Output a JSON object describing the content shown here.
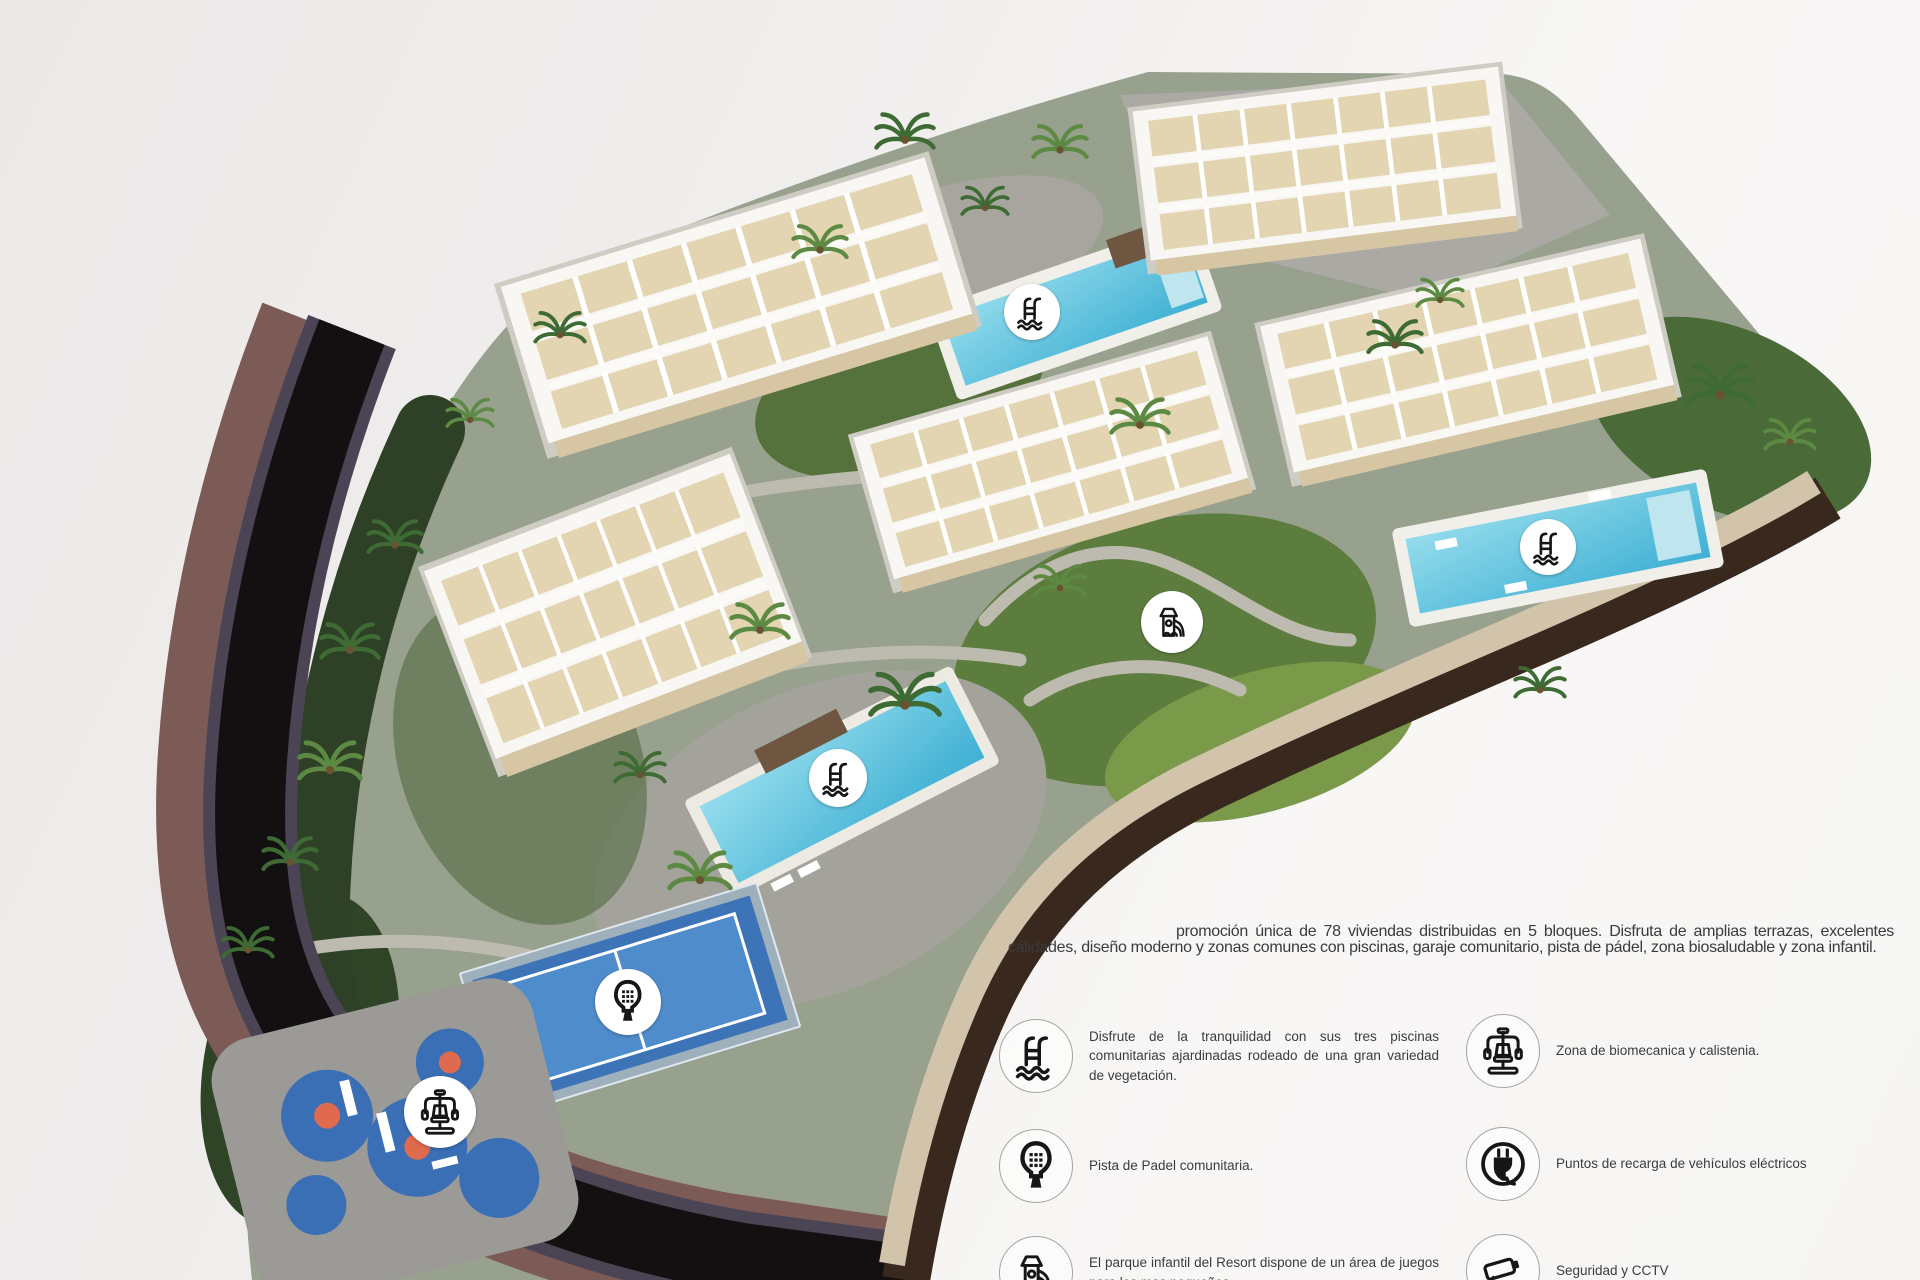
{
  "intro": {
    "text": "promoción única de 78 viviendas distribuidas en 5 bloques. Disfruta de amplias terrazas, excelentes cálidades, diseño moderno y zonas comunes con piscinas, garaje comunitario, pista de pádel, zona biosaludable y zona infantil."
  },
  "legend": {
    "items": [
      {
        "icon": "pool-icon",
        "text": "Disfrute de la tranquilidad con sus tres piscinas comunitarias ajardinadas rodeado de una gran variedad de vegetación."
      },
      {
        "icon": "padel-icon",
        "text": "Pista de Padel comunitaria."
      },
      {
        "icon": "playground-icon",
        "text": "El parque infantil del Resort dispone de un área de juegos para los mas pequeños."
      },
      {
        "icon": "biomechanics-icon",
        "text": "Zona de biomecanica y calistenia."
      },
      {
        "icon": "ev-charging-icon",
        "text": "Puntos de recarga de vehículos eléctricos"
      },
      {
        "icon": "cctv-icon",
        "text": "Seguridad y CCTV"
      }
    ]
  },
  "map_badges": [
    {
      "name": "map-badge-pool-north",
      "icon": "pool-icon"
    },
    {
      "name": "map-badge-pool-east",
      "icon": "pool-icon"
    },
    {
      "name": "map-badge-pool-west",
      "icon": "pool-icon"
    },
    {
      "name": "map-badge-padel",
      "icon": "padel-icon"
    },
    {
      "name": "map-badge-playground",
      "icon": "playground-icon"
    },
    {
      "name": "map-badge-biomechanics",
      "icon": "biomechanics-icon"
    }
  ],
  "colors": {
    "background": "#f2f0ef",
    "ink": "#3b3b3b",
    "pool_water": "#62c3dd",
    "road_asphalt": "#141011",
    "perimeter_wall": "#7c5a56",
    "grass": "#5d7d3e",
    "padel_court_blue": "#3d74b8",
    "badge_background": "#ffffff"
  }
}
